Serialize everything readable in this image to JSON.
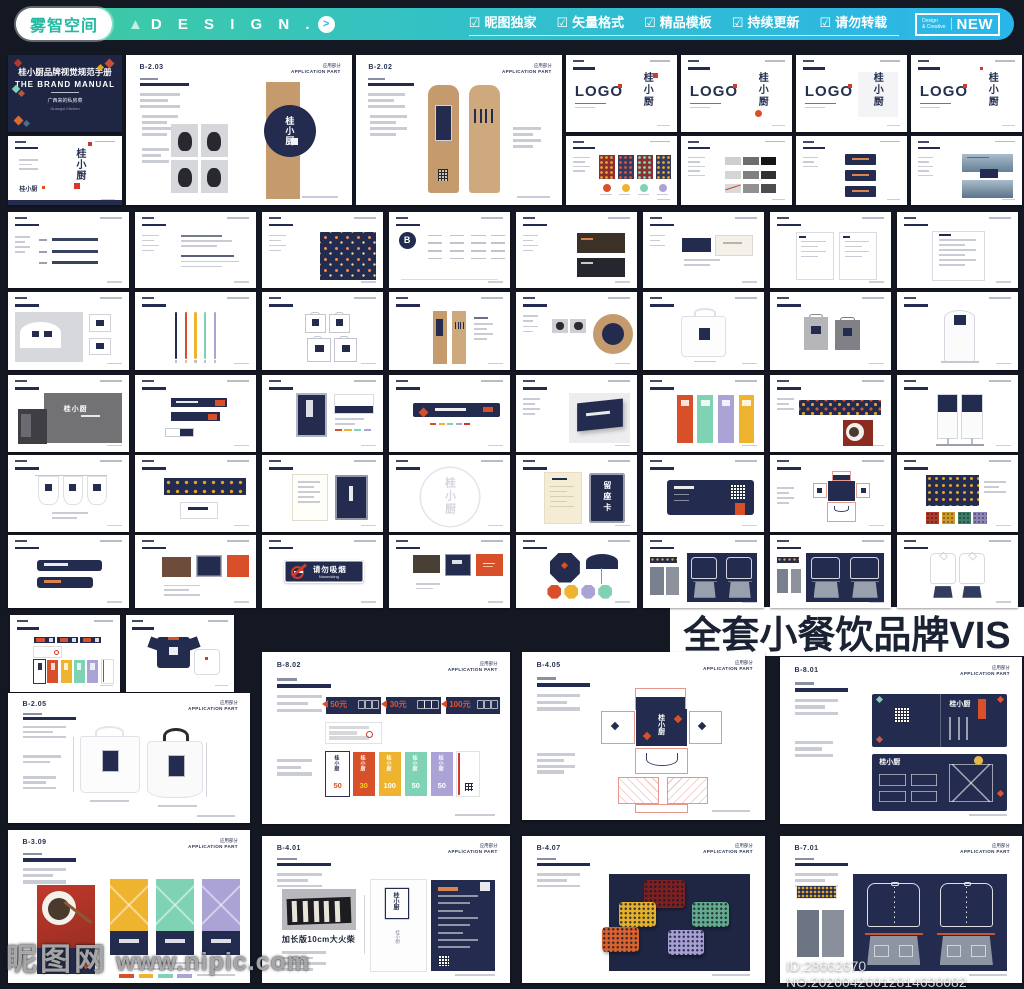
{
  "header": {
    "logo_text": "雾智空间",
    "triangle_icon": "▲",
    "brand_text": "D E S I G N .",
    "arrow_icon": ">",
    "menu_items": [
      {
        "icon": "☑",
        "label": "昵图独家"
      },
      {
        "icon": "☑",
        "label": "矢量格式"
      },
      {
        "icon": "☑",
        "label": "精品模板"
      },
      {
        "icon": "☑",
        "label": "持续更新"
      },
      {
        "icon": "☑",
        "label": "请勿转载"
      }
    ],
    "badge": {
      "small_line1": "Design",
      "small_line2": "& Creative",
      "text": "NEW"
    }
  },
  "overlay": {
    "title": "全套小餐饮品牌VIS"
  },
  "watermark": {
    "site": "昵图网",
    "url": "www.nipic.com",
    "id_line": "ID:28662670 NO:20200426012814638082"
  },
  "cover": {
    "title": "桂小厨品牌视觉规范手册",
    "subtitle": "THE BRAND MANUAL",
    "tagline": "广西来的私房菜",
    "note": "Guangxi Kitchen"
  },
  "brand": {
    "chars": "桂小厨",
    "logo_label": "LOGO"
  },
  "page_chrome": {
    "dept_cn": "应用部分",
    "dept_en": "APPLICATION PART"
  },
  "texts": {
    "matches_caption": "加长版10cm大火柴",
    "no_smoking_cn": "请勿吸烟",
    "no_smoking_en": "Nosmoking",
    "reserve_card": "留座卡",
    "contents_letter": "B"
  },
  "vouchers": {
    "banners": [
      "50元",
      "30元",
      "100元"
    ],
    "tickets": [
      {
        "value": "50",
        "bg": "#ffffff",
        "fg": "#d8502a"
      },
      {
        "value": "30",
        "bg": "#d8502a",
        "fg": "#f7d21e"
      },
      {
        "value": "100",
        "bg": "#efb42f",
        "fg": "#ffffff"
      },
      {
        "value": "50",
        "bg": "#7fd3b4",
        "fg": "#ffffff"
      },
      {
        "value": "50",
        "bg": "#aba3d6",
        "fg": "#ffffff"
      }
    ]
  },
  "palette": {
    "bg": "#141823",
    "navy": "#232c4e",
    "navy_deep": "#1e2644",
    "orange": "#d8502a",
    "red": "#c8382b",
    "yellow": "#efb42f",
    "teal": "#7fd3b4",
    "purple": "#aba3d6",
    "kraft": "#c59b6d",
    "kraft_light": "#cfa97e",
    "cream": "#f5ecd6",
    "ink": "#26304f",
    "accent_green": "#3fcb9e",
    "accent_cyan": "#2ab5ea"
  },
  "row1": {
    "cover": {
      "x": 8,
      "y": 55,
      "w": 114,
      "h": 77
    },
    "logo_intro": {
      "x": 8,
      "y": 136,
      "w": 114,
      "h": 69
    },
    "cups_page": {
      "x": 126,
      "y": 55,
      "w": 226,
      "h": 150,
      "code": "B-2.03"
    },
    "kraft_page": {
      "x": 356,
      "y": 55,
      "w": 206,
      "h": 150,
      "code": "B-2.02"
    },
    "logo_x": [
      566,
      681,
      796,
      911
    ],
    "logo_y": 55,
    "logo_w": 111,
    "logo_h": 77,
    "under_y": 136,
    "under_h": 69,
    "under_types": [
      "patterns4",
      "grayscale",
      "navyCards3",
      "photoPages"
    ]
  },
  "grid": {
    "col_x": [
      8,
      135,
      262,
      389,
      516,
      643,
      770,
      897
    ],
    "col_w": 121,
    "rows": [
      {
        "y": 212,
        "h": 76,
        "cells": [
          "bullets",
          "typography",
          "navyPattern",
          "contents",
          "darkMenus",
          "cardNavy",
          "sheets",
          "sheet"
        ]
      },
      {
        "y": 292,
        "h": 78,
        "cells": [
          "cupSleeve",
          "pens",
          "bagsDiagram",
          "kraftSleeves",
          "cupsKraft",
          "tote",
          "grayBags",
          "standee"
        ]
      },
      {
        "y": 375,
        "h": 77,
        "cells": [
          "storefront",
          "wayfinding",
          "posterCard",
          "longBanner",
          "signPhoto",
          "doorBanners",
          "patternBand",
          "rollups"
        ]
      },
      {
        "y": 455,
        "h": 77,
        "cells": [
          "flags",
          "bannerPattern",
          "menuBook",
          "circleMark",
          "letterCard",
          "vipSpread",
          "dielineSmall",
          "swatchPattern"
        ]
      },
      {
        "y": 535,
        "h": 73,
        "cells": [
          "tableCards",
          "redNavy",
          "nosmoking",
          "folder",
          "umbrella",
          "uniformPhoto",
          "uniformNavy",
          "whiteUniform"
        ]
      }
    ],
    "row7": {
      "y": 615,
      "h": 77,
      "cells": [
        {
          "x": 10,
          "w": 110,
          "type": "vouchersMini"
        },
        {
          "x": 126,
          "w": 108,
          "type": "tshirts"
        }
      ]
    }
  },
  "pages": [
    {
      "code": "B-2.05",
      "x": 8,
      "y": 693,
      "w": 242,
      "h": 130,
      "type": "totePage"
    },
    {
      "code": "B-8.02",
      "x": 262,
      "y": 652,
      "w": 248,
      "h": 172,
      "type": "voucherPage"
    },
    {
      "code": "B-4.05",
      "x": 522,
      "y": 652,
      "w": 243,
      "h": 168,
      "type": "dielinePage"
    },
    {
      "code": "B-8.01",
      "x": 780,
      "y": 657,
      "w": 242,
      "h": 167,
      "type": "menuCardsPage"
    },
    {
      "code": "B-3.09",
      "x": 8,
      "y": 830,
      "w": 242,
      "h": 153,
      "type": "posterPage"
    },
    {
      "code": "B-4.01",
      "x": 262,
      "y": 836,
      "w": 248,
      "h": 147,
      "type": "chopstickPage"
    },
    {
      "code": "B-4.07",
      "x": 522,
      "y": 836,
      "w": 243,
      "h": 147,
      "type": "cushionPage"
    },
    {
      "code": "B-7.01",
      "x": 780,
      "y": 836,
      "w": 242,
      "h": 147,
      "type": "uniformPage"
    }
  ]
}
